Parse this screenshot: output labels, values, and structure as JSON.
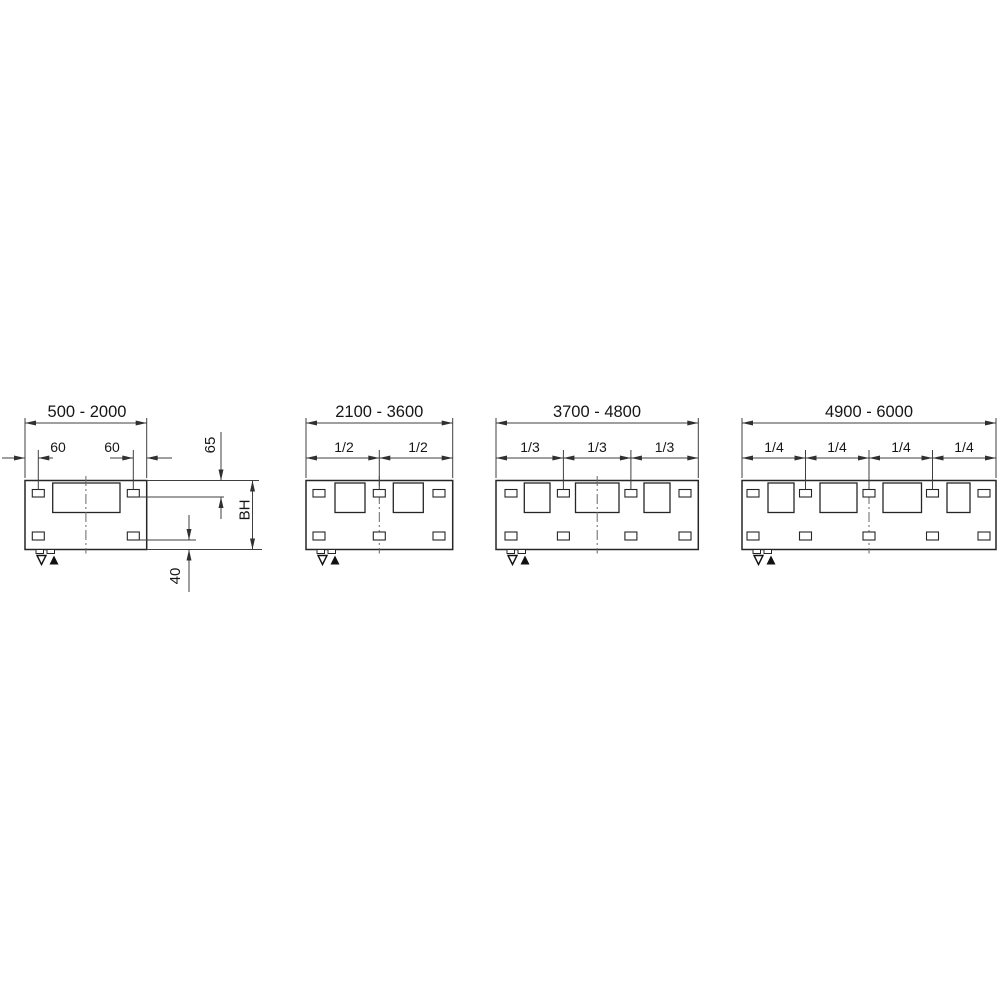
{
  "diagrams": [
    {
      "id": "500-2000",
      "range_label": "500 - 2000",
      "offsets": [
        "60",
        "60"
      ],
      "side_labels": {
        "top_offset": "65",
        "build_height": "BH",
        "bottom_offset": "40"
      }
    },
    {
      "id": "2100-3600",
      "range_label": "2100 - 3600",
      "fractions": [
        "1/2",
        "1/2"
      ]
    },
    {
      "id": "3700-4800",
      "range_label": "3700 - 4800",
      "fractions": [
        "1/3",
        "1/3",
        "1/3"
      ]
    },
    {
      "id": "4900-6000",
      "range_label": "4900 - 6000",
      "fractions": [
        "1/4",
        "1/4",
        "1/4",
        "1/4"
      ]
    }
  ],
  "symbols": {
    "vent_icon": "outline-triangle-down",
    "drain_icon": "filled-triangle-up"
  },
  "colors": {
    "line": "#3f3f3f",
    "outline": "#262626",
    "text": "#161616",
    "background": "#ffffff"
  }
}
